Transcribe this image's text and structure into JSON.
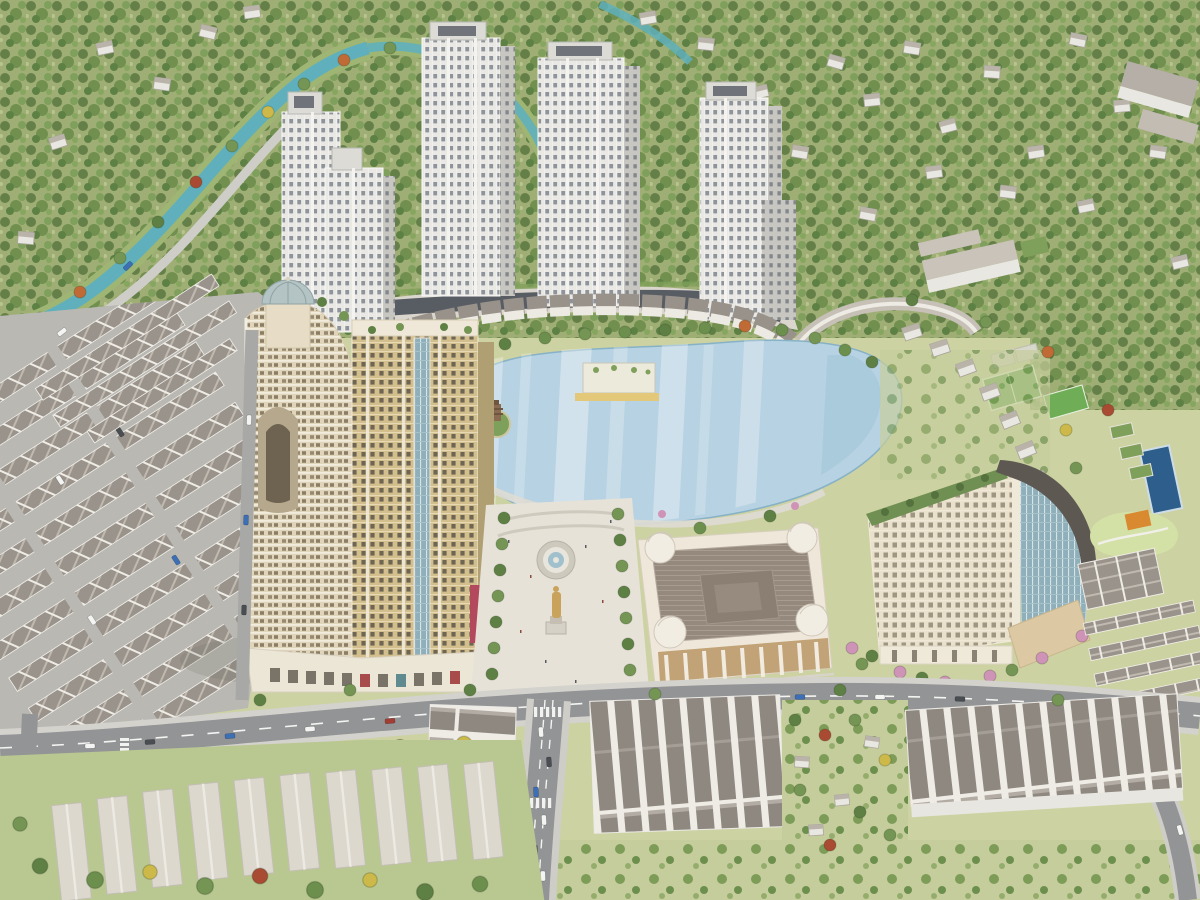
{
  "scene": {
    "title": "Aerial 3D rendering of a mixed-use residential masterplan",
    "view": "bird's-eye perspective",
    "elements": [
      "surrounding forest with scattered villas",
      "winding turquoise canal",
      "cluster of white high-rise apartment towers on a podium",
      "central lake with pagoda island and lakeside clubhouse",
      "curved cream tower with glass dome turret",
      "gold residential tower",
      "fountain plaza with golden statue",
      "classical exhibition hall with corner domes",
      "curved hotel block with glass corner",
      "townhouse and shophouse districts",
      "sports pitches, courts and swimming pool",
      "tree-lined boulevard and roads with cars"
    ]
  },
  "colors": {
    "ground": "#cdd2a3",
    "forest": "#9fae74",
    "canal": "#5fb0bc",
    "lake": "#b7d2e2",
    "road": "#939496",
    "sidewalk": "#d4d2cd",
    "plaza": "#e6e2d8",
    "tower_face": "#e9e8e4",
    "tower_side": "#c7c6c1",
    "gold_facade": "#d3bf8e",
    "cream_facade": "#e9e1cc",
    "balcony_cream": "#e0d4ba",
    "glass": "#8fb0ba",
    "dome_glass": "#b4c3c4",
    "hall_roof": "#95897e",
    "hall_wall": "#efe8da",
    "curved_roof": "#5e5852",
    "townhouse_roof": "#9a938b",
    "townhouse_wall": "#efece6",
    "shed_roof": "#dcd8ce",
    "statue_gold": "#c9a35b",
    "blossom_pink": "#cf93b8",
    "pitch": "#61a24b",
    "pool": "#2e5f8c",
    "tree_dark": "#5f8044",
    "tree_mid": "#749553",
    "tree_light": "#8aa964",
    "tree_orange": "#c06a35",
    "tree_red": "#a84b32",
    "tree_yellow": "#cdb84a",
    "car_white": "#f4f4f2",
    "car_dark": "#4a4d52",
    "car_blue": "#3d6fb4",
    "car_red": "#a33d33"
  }
}
